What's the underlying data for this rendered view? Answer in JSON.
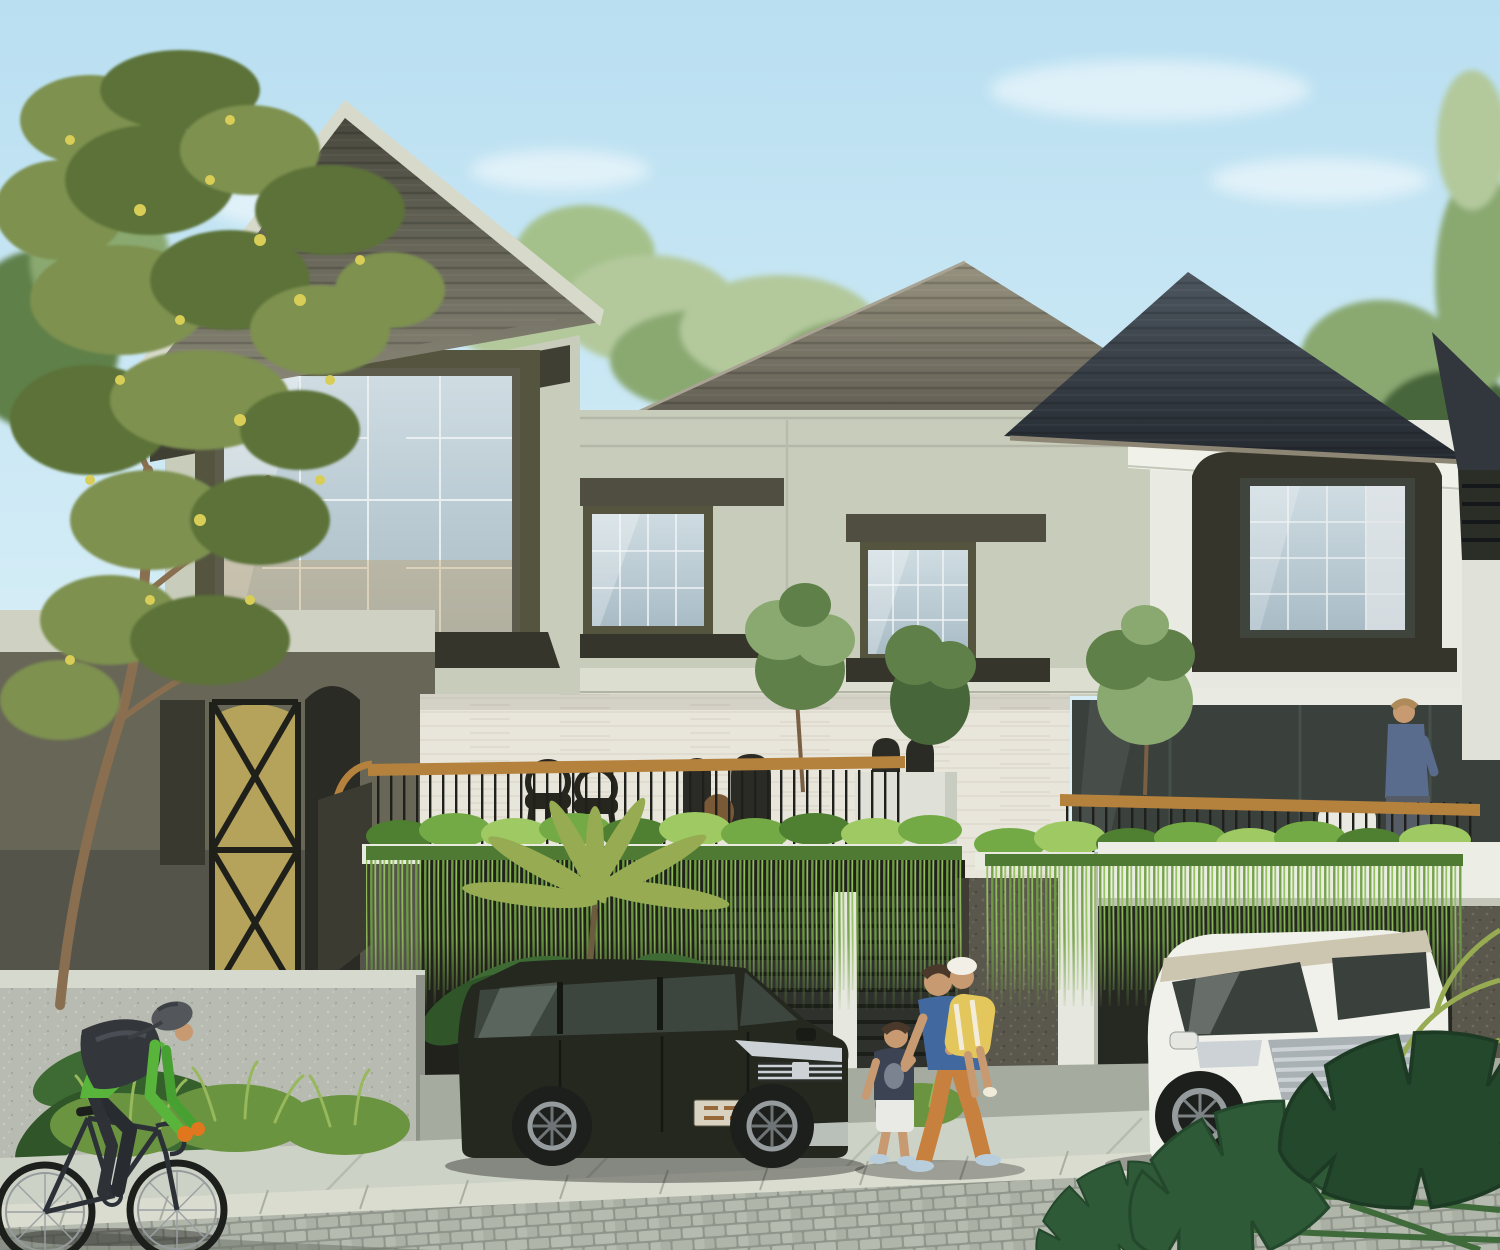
{
  "scene": {
    "setting": "daytime architectural rendering of a row of modern two-storey tropical townhouses",
    "objects": [
      "hip tile roofs",
      "sage stucco facade",
      "dark framed windows",
      "travertine terrace wall",
      "wood-top balcony railing",
      "hanging grass curtain over carports",
      "black suv",
      "white mpv",
      "family walking on sidewalk",
      "cyclist on street",
      "stone fence",
      "monstera leaves"
    ]
  },
  "palette": {
    "sky_top": "#b9dff1",
    "sky_mid": "#d7eef7",
    "sky_bottom": "#ecf7fa",
    "cloud": "#ffffff",
    "tree_pale": "#b3c99c",
    "tree_mid": "#8aa971",
    "tree_dark": "#5f8049",
    "tree_deep": "#47663a",
    "olive_leaf": "#7e9150",
    "olive_leaf_dark": "#5c7239",
    "blossom": "#d8cd56",
    "trunk": "#8a6e50",
    "roof_left_top": "#45453b",
    "roof_left_bottom": "#8d8a7a",
    "roof_back_top": "#97927f",
    "roof_back_bottom": "#5c594f",
    "roof_right_top": "#4d565f",
    "roof_right_bottom": "#242930",
    "fascia": "#d7dacb",
    "eave_dark": "#403f33",
    "wall_sage": "#c8ccba",
    "wall_molding": "#dcdfd0",
    "wall_white": "#e9eae2",
    "backdrop_white": "#eceee6",
    "frame_olive": "#54543f",
    "frame_dark": "#35352c",
    "lintel": "#4f4e41",
    "glass_light": "#cfdce2",
    "glass_mid": "#a9bcc6",
    "glass_dark": "#3a403c",
    "interior_warm": "#c39c59",
    "curtain": "#e2e6e8",
    "travertine": "#e8e5da",
    "arch_dark": "#2b2b25",
    "pier_white": "#dfe1d8",
    "ground_olive": "#686656",
    "door_amber": "#b5a35c",
    "gate_black": "#20201a",
    "rail_wood": "#b5823e",
    "rail_black": "#1f1f1c",
    "plant_bright": "#74aa46",
    "plant_light": "#9ec963",
    "plant_dark": "#4f7f30",
    "grass_strand": "#6f9f42",
    "grass_strand_light": "#93c05e",
    "planter_shadow": "#4e7a33",
    "slab_white": "#e9ebe1",
    "carport_dark": "#20221b",
    "speckle_wall": "#5a574c",
    "column_white": "#e6e7df",
    "beam_white": "#eceee6",
    "slat": "#2f322c",
    "slat_line": "#1b1e19",
    "stone_wall": "#b8bbb1",
    "stone_cap": "#d6d9cd",
    "bush": "#6b9440",
    "bush_light": "#97b85c",
    "apron": "#a6ab9f",
    "sidewalk": "#cdd2c6",
    "curb": "#dadcd0",
    "cobble": "#b0b5aa",
    "cobble_line": "#8f958b",
    "street_shadow": "#6f756c",
    "suv_body": "#24281f",
    "suv_glass": "#3d453f",
    "chrome": "#ccd2d5",
    "plate_tan": "#d9d2c0",
    "plate_text": "#96683a",
    "van_body": "#f1f1eb",
    "van_roof": "#ccc5b0",
    "van_glass": "#3a403c",
    "van_plate": "#f4f4f0",
    "tire": "#1c1f1b",
    "rim": "#969c9e",
    "skin": "#c89a72",
    "hair_dark": "#4a392b",
    "hair_light": "#b08b5a",
    "father_shirt": "#41699f",
    "father_pants": "#c8803e",
    "shoe_light": "#b9cedd",
    "boy_shirt": "#3c4352",
    "boy_shorts": "#e9eae5",
    "child_hat": "#f1efe6",
    "child_outfit": "#e3c65c",
    "jersey_green": "#58b43b",
    "rider_dark": "#282b30",
    "glove_orange": "#e0771f",
    "helmet_gray": "#53575c",
    "backpack": "#33363b",
    "bike_frame": "#2c3137",
    "monstera": "#2e5a37",
    "monstera_dark": "#24482c",
    "fern": "#96ab52",
    "tropical": "#3e6a33",
    "shadow": "#3c4138"
  }
}
